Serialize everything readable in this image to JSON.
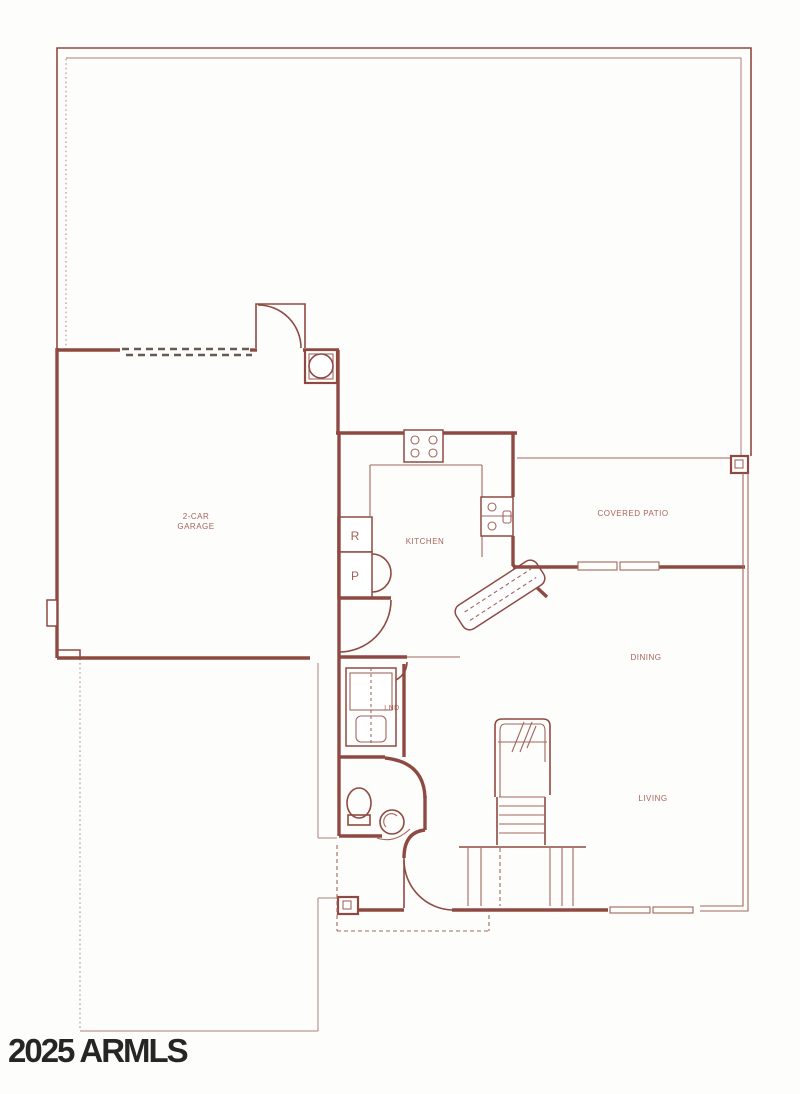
{
  "floorplan": {
    "title": "Residential floor plan",
    "watermark": "2025 ARMLS",
    "rooms": {
      "garage": {
        "line1": "2-CAR",
        "line2": "GARAGE"
      },
      "kitchen": {
        "label": "KITCHEN"
      },
      "patio": {
        "label": "COVERED PATIO"
      },
      "dining": {
        "label": "DINING"
      },
      "living": {
        "label": "LIVING"
      },
      "laundry": {
        "label": "LND"
      }
    },
    "appliances": {
      "refrigerator": "R",
      "pantry": "P"
    },
    "colors": {
      "wall": "#8e4a42",
      "line": "#a2675d",
      "faint": "#b08078",
      "dashcol": "#6b5a54",
      "label": "#9f564c",
      "watermark": "#161616",
      "background": "#fdfdfc"
    }
  }
}
